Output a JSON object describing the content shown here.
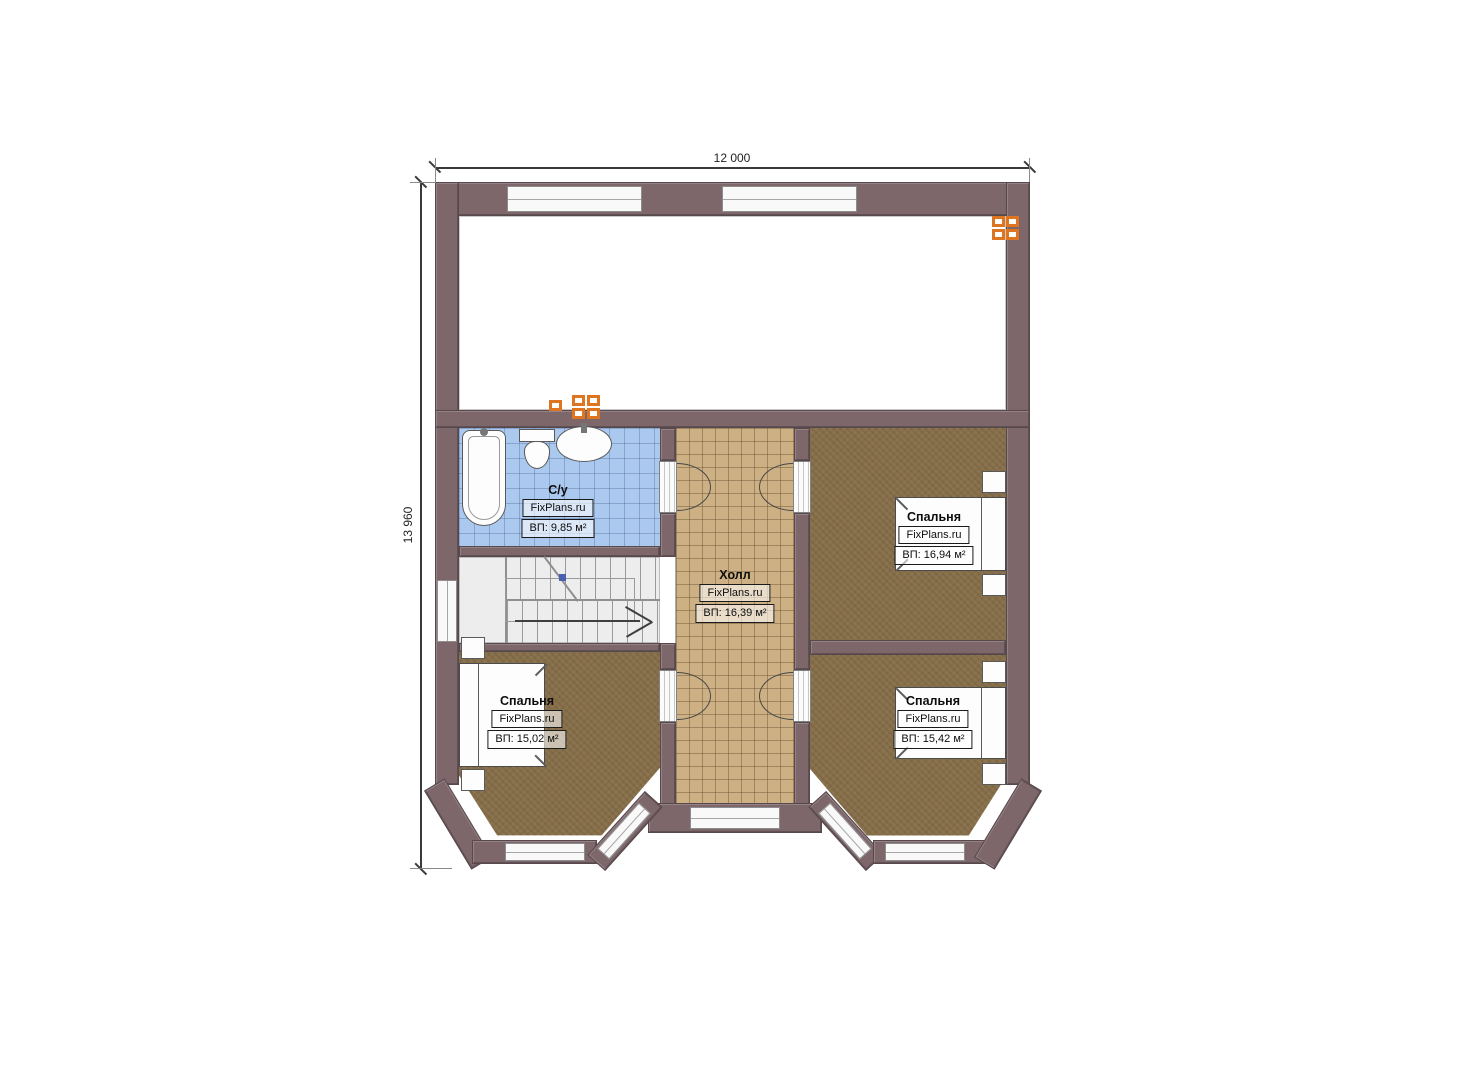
{
  "dimensions": {
    "width_label": "12 000",
    "height_label": "13 960"
  },
  "rooms": [
    {
      "id": "bathroom",
      "name": "С/у",
      "brand": "FixPlans.ru",
      "area": "ВП: 9,85 м²"
    },
    {
      "id": "hall",
      "name": "Холл",
      "brand": "FixPlans.ru",
      "area": "ВП: 16,39 м²"
    },
    {
      "id": "bedroom-top-right",
      "name": "Спальня",
      "brand": "FixPlans.ru",
      "area": "ВП: 16,94 м²"
    },
    {
      "id": "bedroom-bottom-left",
      "name": "Спальня",
      "brand": "FixPlans.ru",
      "area": "ВП: 15,02 м²"
    },
    {
      "id": "bedroom-bottom-right",
      "name": "Спальня",
      "brand": "FixPlans.ru",
      "area": "ВП: 15,42 м²"
    }
  ],
  "colors": {
    "wall": "#7d676b",
    "carpet": "#8b734e",
    "hall_tile": "#cdb184",
    "bath_tile": "#abc9ee",
    "vent_accent": "#de7520"
  }
}
